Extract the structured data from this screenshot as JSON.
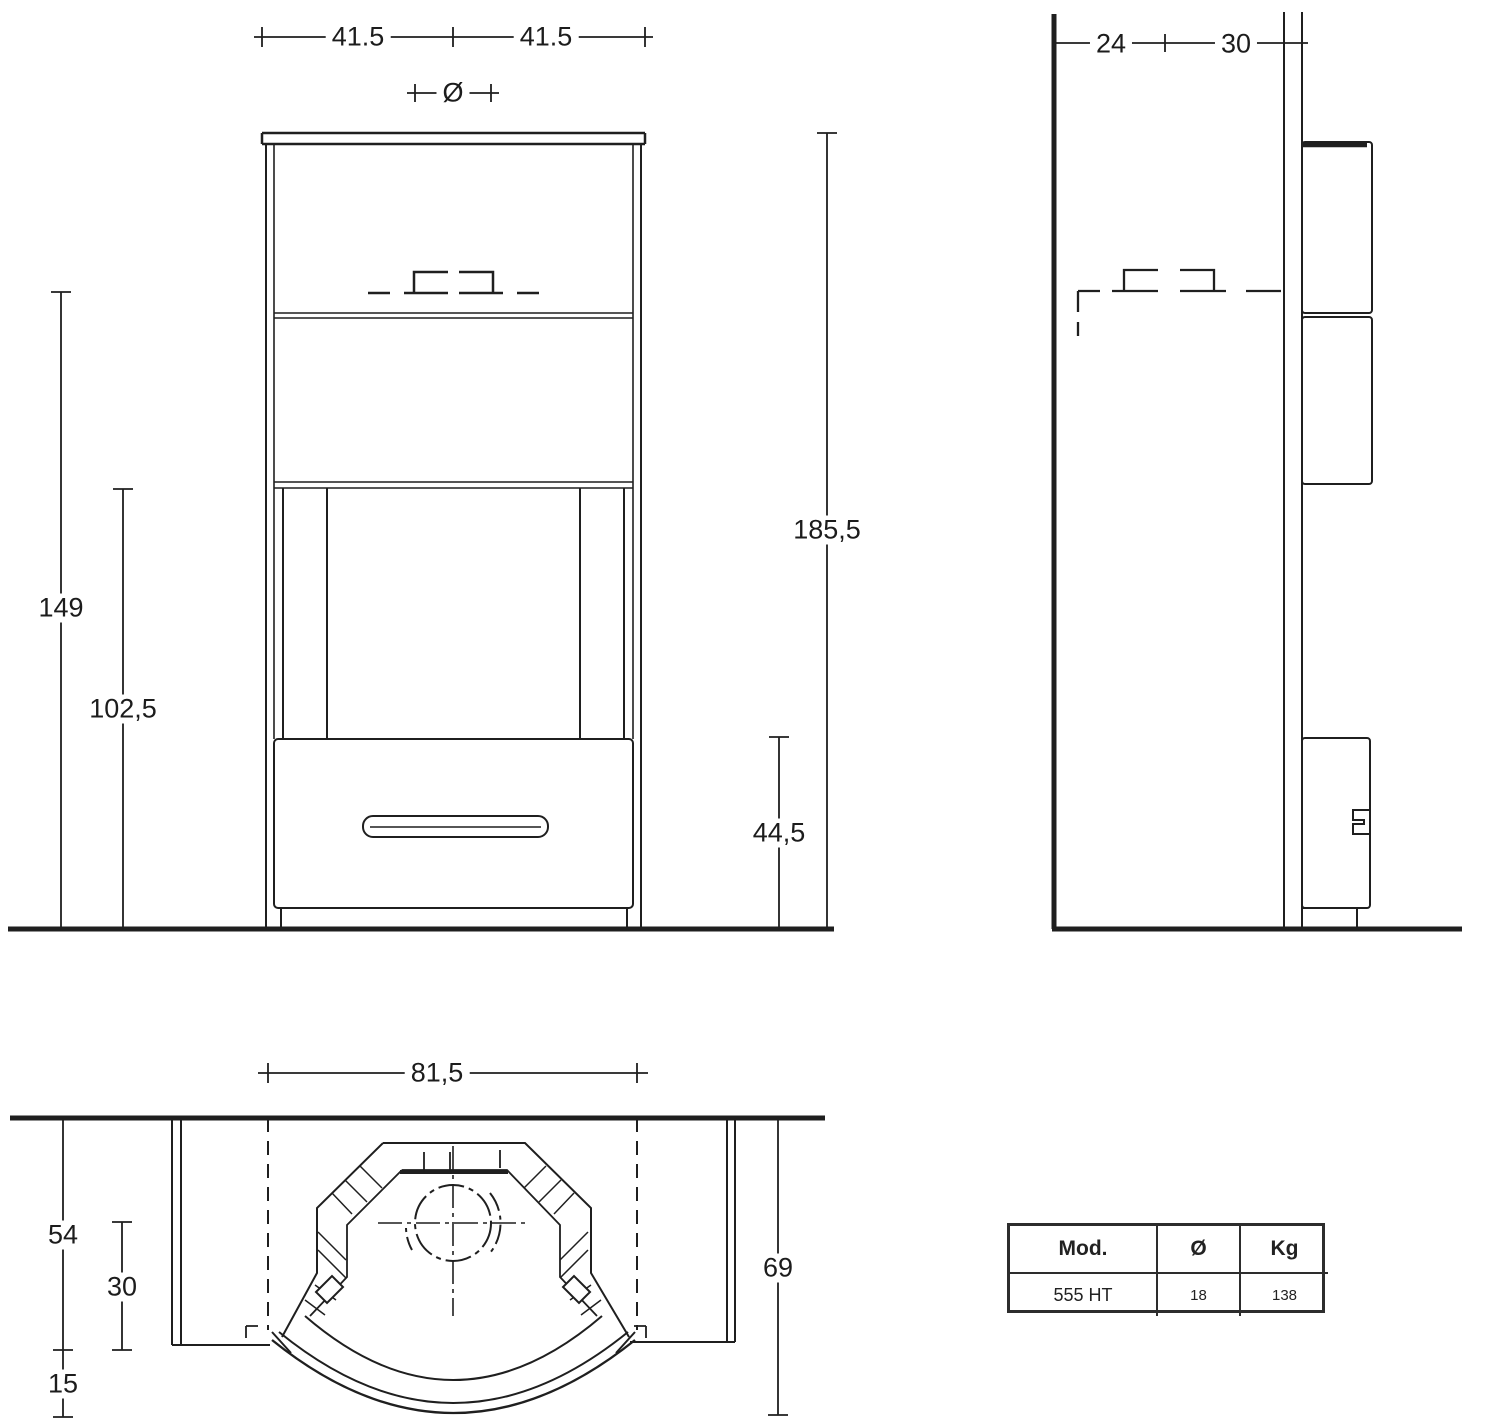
{
  "front_view": {
    "dim_half_width_left": "41.5",
    "dim_half_width_right": "41.5",
    "dim_flue_diameter_symbol": "Ø",
    "dim_flue_height": "149",
    "dim_opening_height": "102,5",
    "dim_total_height": "185,5",
    "dim_base_height": "44,5"
  },
  "side_view": {
    "dim_wall_clearance": "24",
    "dim_rear_depth": "30"
  },
  "top_view": {
    "dim_width": "81,5",
    "dim_depth_front": "54",
    "dim_depth_mid": "30",
    "dim_depth_bow": "15",
    "dim_total_depth": "69"
  },
  "spec_table": {
    "headers": {
      "model": "Mod.",
      "diameter": "Ø",
      "weight": "Kg"
    },
    "row": {
      "model": "555 HT",
      "diameter": "18",
      "weight": "138"
    }
  }
}
